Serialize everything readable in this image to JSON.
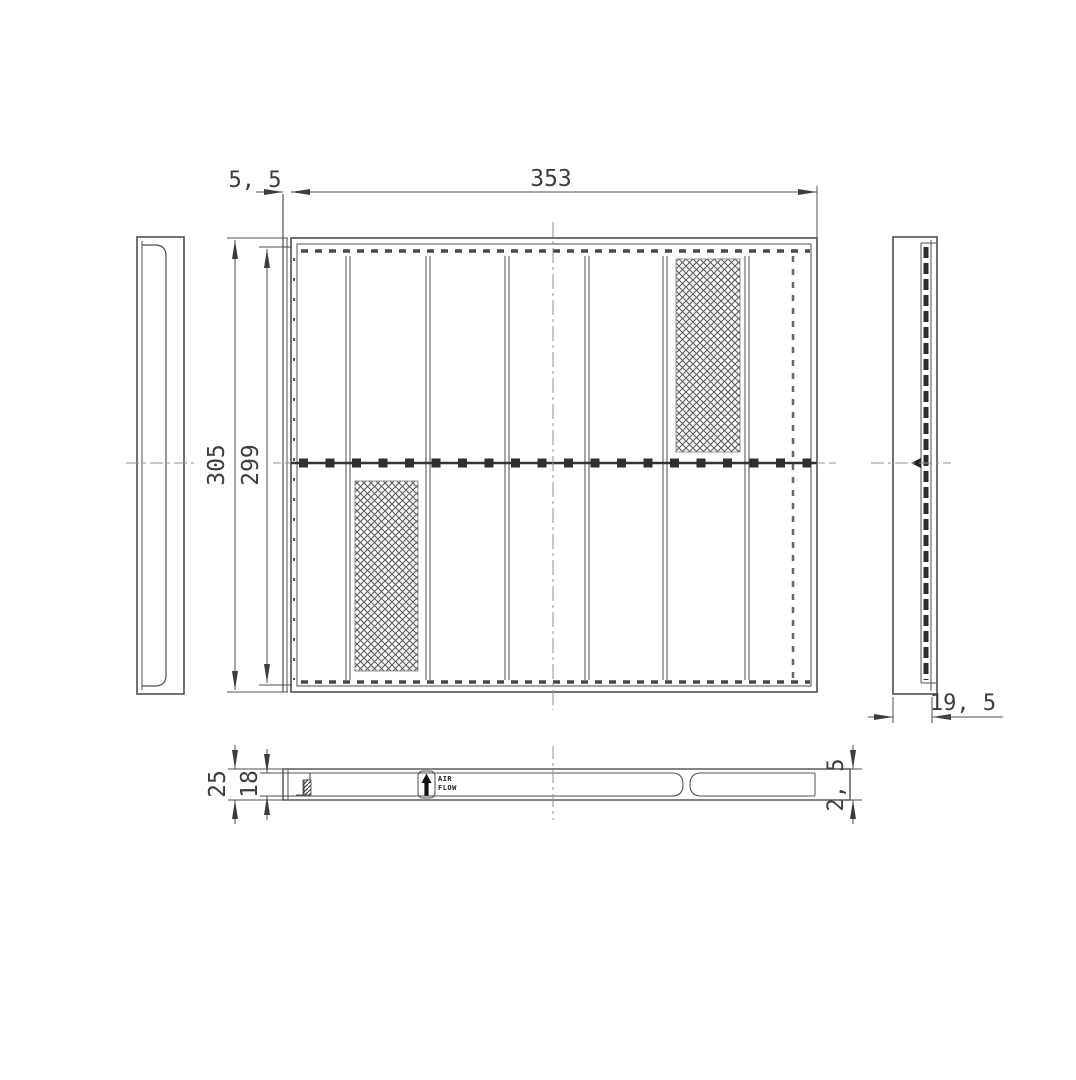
{
  "drawing": {
    "dimensions": {
      "front_width": "353",
      "front_left_flange": "5, 5",
      "front_height_outer": "305",
      "front_height_inner": "299",
      "side_depth": "19, 5",
      "bottom_depth_outer": "25",
      "bottom_depth_inner": "18",
      "bottom_end_thickness": "2, 5"
    },
    "labels": {
      "air_flow_line1": "AIR",
      "air_flow_line2": "FLOW"
    },
    "colors": {
      "line": "#4f4f4f",
      "dark_line": "#2f2f2f",
      "centerline": "#909090",
      "text": "#3d3d3d",
      "background": "#ffffff"
    }
  }
}
